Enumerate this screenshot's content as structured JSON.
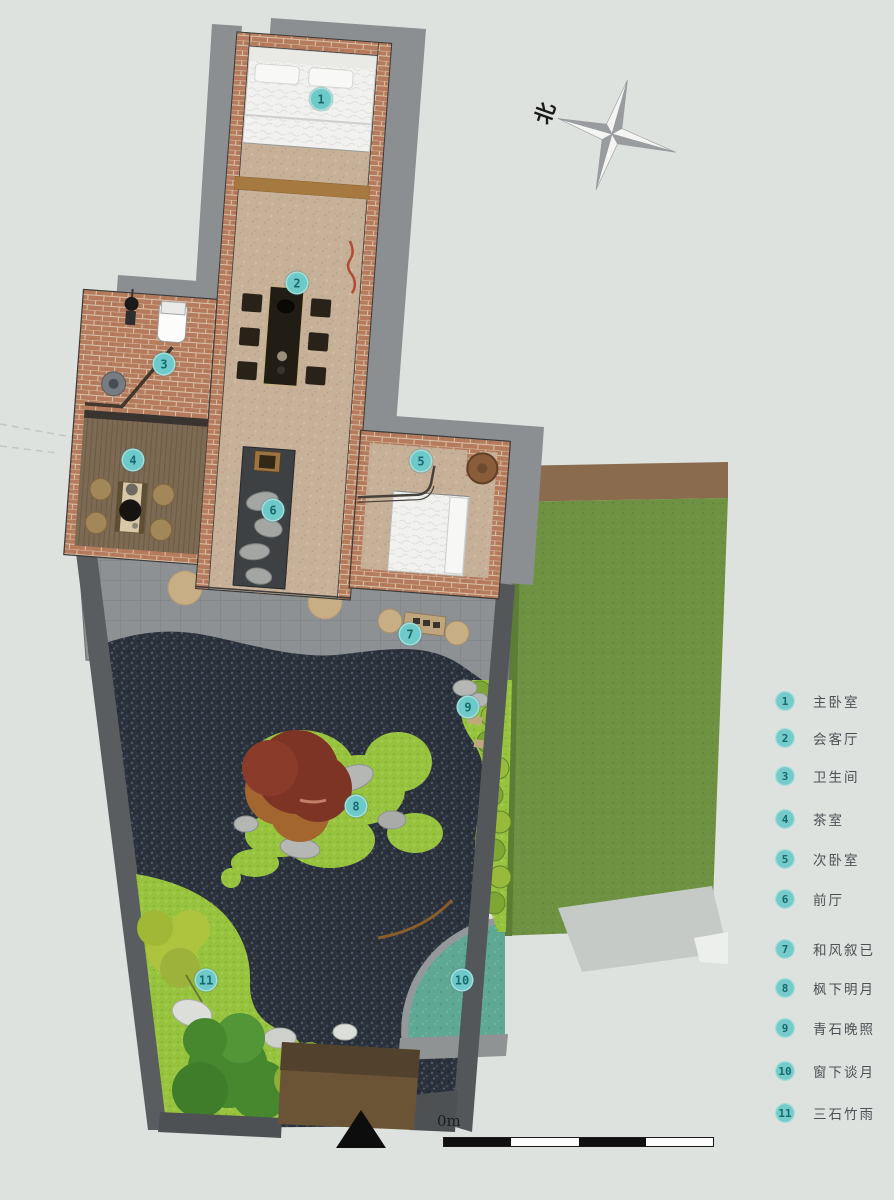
{
  "compass": {
    "north_label": "北"
  },
  "scale_bar": {
    "origin_label": "0m"
  },
  "legend": {
    "items": [
      {
        "number": "1",
        "label": "主卧室"
      },
      {
        "number": "2",
        "label": "会客厅"
      },
      {
        "number": "3",
        "label": "卫生间"
      },
      {
        "number": "4",
        "label": "茶室"
      },
      {
        "number": "5",
        "label": "次卧室"
      },
      {
        "number": "6",
        "label": "前厅"
      },
      {
        "number": "7",
        "label": "和风叙已"
      },
      {
        "number": "8",
        "label": "枫下明月"
      },
      {
        "number": "9",
        "label": "青石晚照"
      },
      {
        "number": "10",
        "label": "窗下谈月"
      },
      {
        "number": "11",
        "label": "三石竹雨"
      }
    ]
  },
  "colors": {
    "marker_fill": "#6ecac8",
    "marker_text": "#18696d",
    "gravel": "#2b323c",
    "moss_green": "#97c33f",
    "pool_teal": "#5fa894",
    "brick": "#b57b5c"
  }
}
